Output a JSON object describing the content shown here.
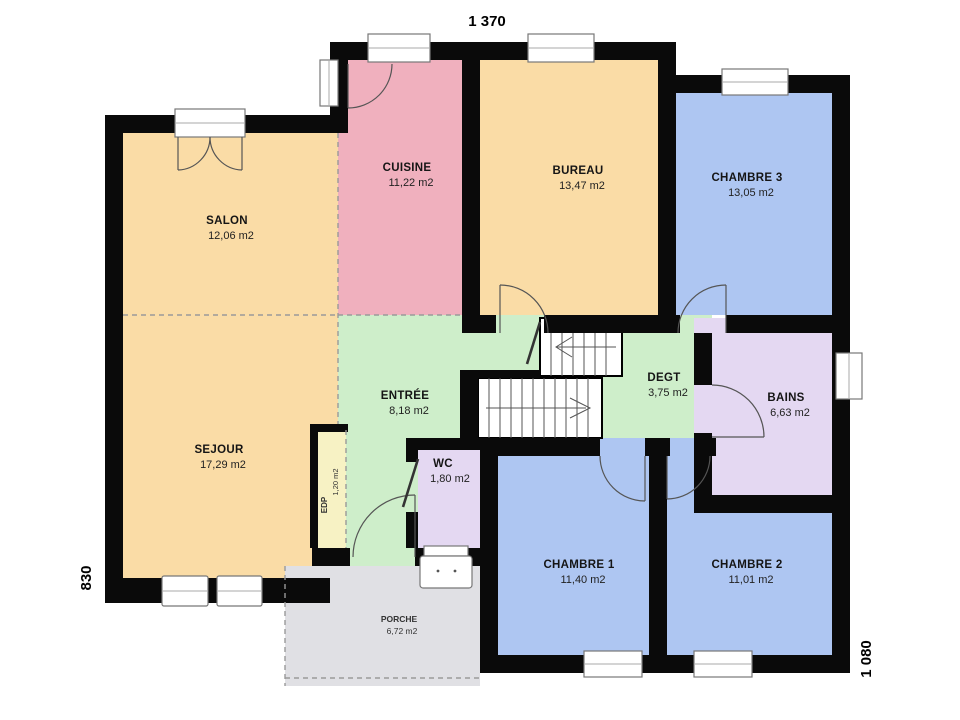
{
  "palette": {
    "wall": "#0a0a0a",
    "tan": "#FADCA6",
    "pink": "#F0B0BE",
    "blue": "#AEC6F2",
    "green": "#CEEECA",
    "lavender": "#E4D8F2",
    "yellow": "#F7F2C4",
    "porch_gray": "#E0E0E4",
    "stair_white": "#FFFFFF"
  },
  "dimensions": {
    "top": "1 370",
    "left": "830",
    "right": "1 080"
  },
  "rooms": {
    "salon": {
      "name": "SALON",
      "area": "12,06 m2"
    },
    "sejour": {
      "name": "SEJOUR",
      "area": "17,29 m2"
    },
    "cuisine": {
      "name": "CUISINE",
      "area": "11,22 m2"
    },
    "bureau": {
      "name": "BUREAU",
      "area": "13,47 m2"
    },
    "chambre3": {
      "name": "CHAMBRE 3",
      "area": "13,05 m2"
    },
    "entree": {
      "name": "ENTRÉE",
      "area": "8,18 m2"
    },
    "degt": {
      "name": "DEGT",
      "area": "3,75 m2"
    },
    "bains": {
      "name": "BAINS",
      "area": "6,63 m2"
    },
    "wc": {
      "name": "WC",
      "area": "1,80 m2"
    },
    "edp": {
      "name": "EDP",
      "area": "1,20 m2"
    },
    "chambre1": {
      "name": "CHAMBRE 1",
      "area": "11,40 m2"
    },
    "chambre2": {
      "name": "CHAMBRE 2",
      "area": "11,01 m2"
    },
    "porche": {
      "name": "PORCHE",
      "area": "6,72 m2"
    }
  }
}
